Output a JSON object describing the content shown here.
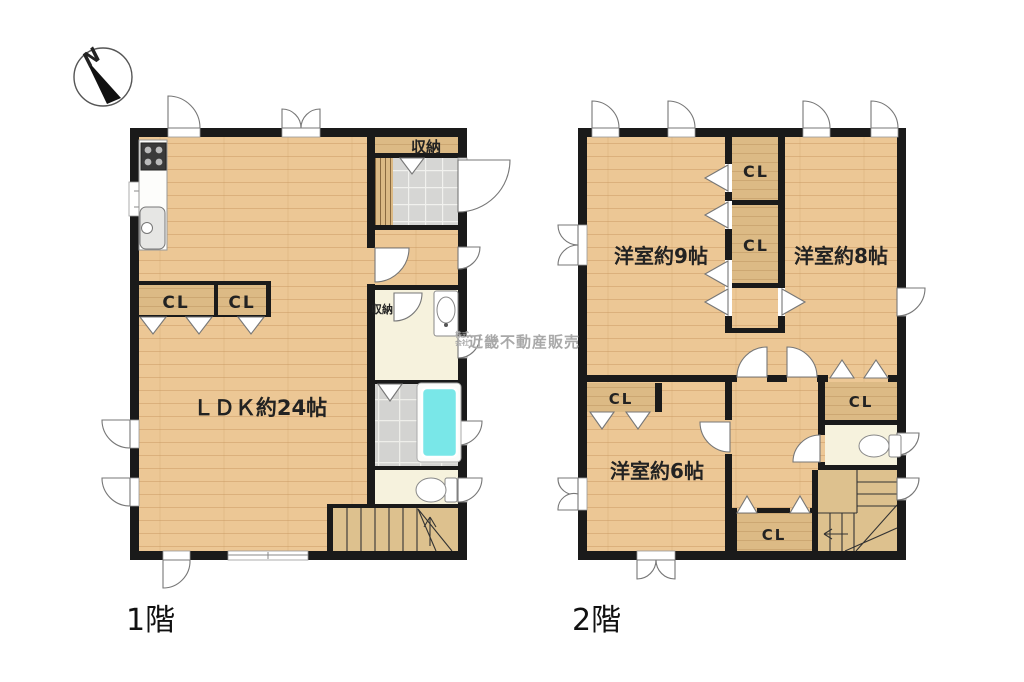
{
  "compass": {
    "north_label": "N"
  },
  "floor1": {
    "name_label": "1階",
    "ldk_label": "ＬＤＫ約24帖",
    "closet1_label": "CL",
    "closet2_label": "CL",
    "storage_top_label": "収納",
    "storage_wash_label": "収納"
  },
  "floor2": {
    "name_label": "2階",
    "room9_label": "洋室約9帖",
    "room8_label": "洋室約8帖",
    "room6_label": "洋室約6帖",
    "closet_a_label": "CL",
    "closet_b_label": "CL",
    "closet_room6_label": "CL",
    "closet_right_label": "CL",
    "closet_bottom_label": "CL"
  },
  "watermark": {
    "prefix_line1": "株式",
    "prefix_line2": "会社",
    "company": "近畿不動産販売"
  },
  "colors": {
    "wall": "#1a1a1a",
    "wood_floor": "#ecc795",
    "closet_wood": "#dcba85",
    "bathtub": "#79e7e8",
    "wet_room_floor": "#f6f2dd",
    "entry_tile": "#d6d6d4",
    "bath_tile": "#d3d3d1"
  }
}
